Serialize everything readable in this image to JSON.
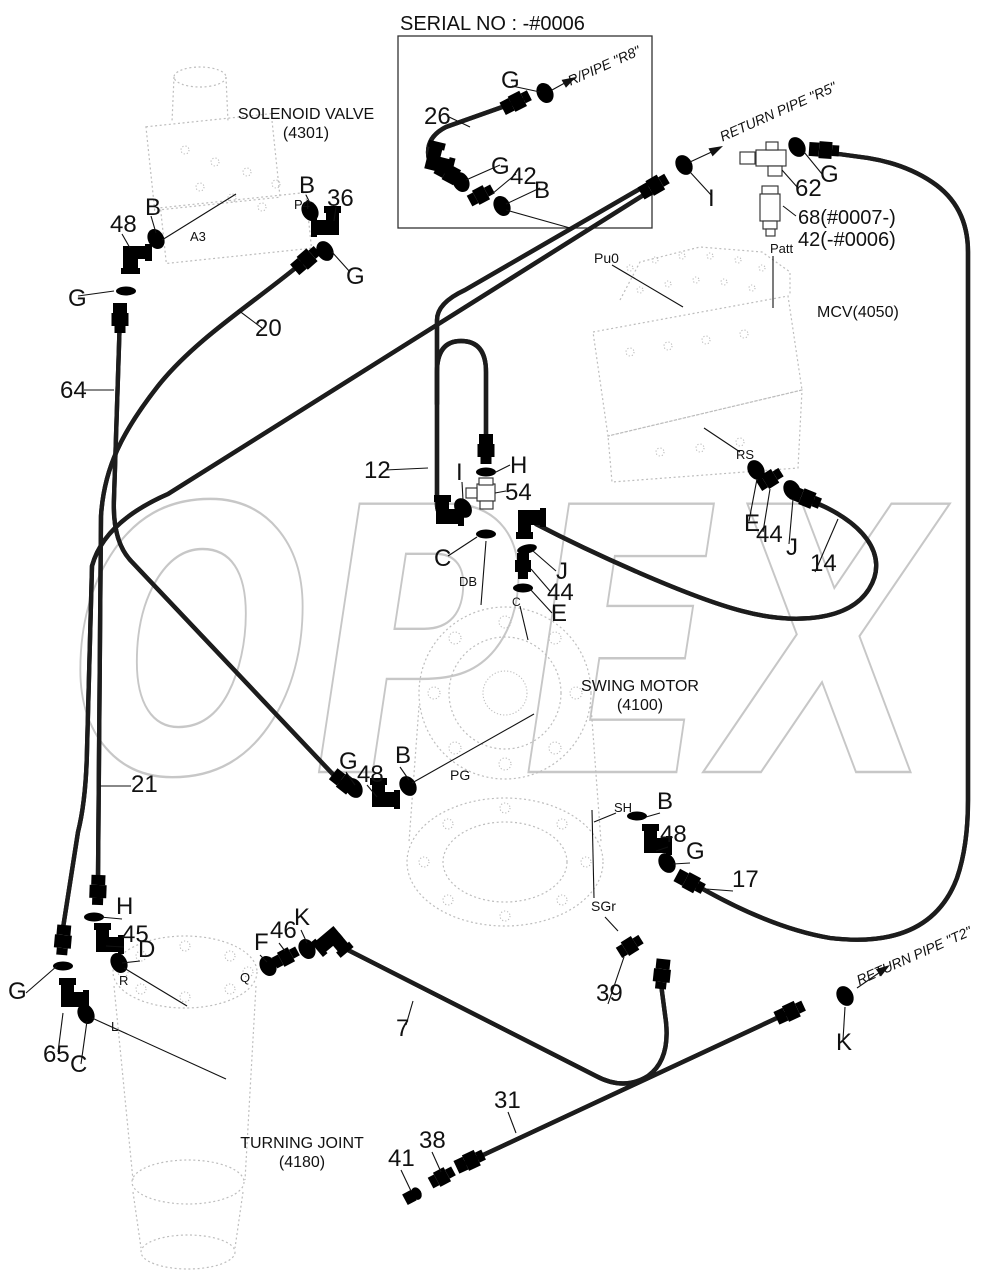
{
  "watermark": "OPEX",
  "serial_box": {
    "title": "SERIAL NO : -#0006"
  },
  "components": [
    {
      "name": "SOLENOID VALVE",
      "code": "(4301)"
    },
    {
      "name": "MCV",
      "code": "(4050)"
    },
    {
      "name": "SWING MOTOR",
      "code": "(4100)"
    },
    {
      "name": "TURNING JOINT",
      "code": "(4180)"
    }
  ],
  "pipe_refs": [
    "R/PIPE \"R8\"",
    "RETURN PIPE \"R5\"",
    "RETURN PIPE \"T2\""
  ],
  "part_numbers": [
    "7",
    "12",
    "14",
    "17",
    "20",
    "21",
    "26",
    "31",
    "36",
    "38",
    "39",
    "41",
    "42",
    "44",
    "45",
    "46",
    "48",
    "54",
    "62",
    "64",
    "65",
    "68(#0007-)",
    "42(-#0006)"
  ],
  "seal_callouts": [
    "B",
    "C",
    "D",
    "E",
    "F",
    "G",
    "H",
    "I",
    "J",
    "K"
  ],
  "port_labels": [
    "A3",
    "P4",
    "Pu0",
    "Patt",
    "RS",
    "DB",
    "C",
    "PG",
    "SH",
    "SGr",
    "R",
    "L",
    "Q"
  ],
  "labels": [
    {
      "t": "SERIAL NO : -#0006",
      "x": 400,
      "y": 30,
      "fs": 20
    },
    {
      "t": "G",
      "x": 501,
      "y": 88,
      "fs": 24
    },
    {
      "t": "26",
      "x": 424,
      "y": 124,
      "fs": 24
    },
    {
      "t": "G",
      "x": 491,
      "y": 174,
      "fs": 24
    },
    {
      "t": "42",
      "x": 510,
      "y": 184,
      "fs": 24
    },
    {
      "t": "B",
      "x": 534,
      "y": 198,
      "fs": 24
    },
    {
      "t": "R/PIPE \"R8\"",
      "x": 606,
      "y": 70,
      "fs": 14,
      "i": 1,
      "r": -24,
      "a": "middle"
    },
    {
      "t": "SOLENOID VALVE",
      "x": 306,
      "y": 119,
      "fs": 16,
      "a": "middle"
    },
    {
      "t": "(4301)",
      "x": 306,
      "y": 138,
      "fs": 16,
      "a": "middle"
    },
    {
      "t": "48",
      "x": 110,
      "y": 232,
      "fs": 24
    },
    {
      "t": "B",
      "x": 145,
      "y": 215,
      "fs": 24
    },
    {
      "t": "B",
      "x": 299,
      "y": 193,
      "fs": 24
    },
    {
      "t": "P4",
      "x": 294,
      "y": 209,
      "fs": 13
    },
    {
      "t": "36",
      "x": 327,
      "y": 206,
      "fs": 24
    },
    {
      "t": "G",
      "x": 346,
      "y": 284,
      "fs": 24
    },
    {
      "t": "A3",
      "x": 190,
      "y": 241,
      "fs": 13
    },
    {
      "t": "20",
      "x": 255,
      "y": 336,
      "fs": 24
    },
    {
      "t": "G",
      "x": 68,
      "y": 306,
      "fs": 24
    },
    {
      "t": "64",
      "x": 60,
      "y": 398,
      "fs": 24
    },
    {
      "t": "RETURN PIPE \"R5\"",
      "x": 780,
      "y": 116,
      "fs": 14,
      "i": 1,
      "r": -24,
      "a": "middle"
    },
    {
      "t": "I",
      "x": 708,
      "y": 206,
      "fs": 24
    },
    {
      "t": "62",
      "x": 795,
      "y": 196,
      "fs": 24
    },
    {
      "t": "G",
      "x": 820,
      "y": 182,
      "fs": 24
    },
    {
      "t": "68(#0007-)",
      "x": 798,
      "y": 224,
      "fs": 20
    },
    {
      "t": "42(-#0006)",
      "x": 798,
      "y": 246,
      "fs": 20
    },
    {
      "t": "Patt",
      "x": 770,
      "y": 253,
      "fs": 13
    },
    {
      "t": "Pu0",
      "x": 594,
      "y": 263,
      "fs": 14
    },
    {
      "t": "MCV(4050)",
      "x": 817,
      "y": 317,
      "fs": 16
    },
    {
      "t": "12",
      "x": 364,
      "y": 478,
      "fs": 24
    },
    {
      "t": "I",
      "x": 456,
      "y": 480,
      "fs": 24
    },
    {
      "t": "H",
      "x": 510,
      "y": 473,
      "fs": 24
    },
    {
      "t": "54",
      "x": 505,
      "y": 500,
      "fs": 24
    },
    {
      "t": "C",
      "x": 434,
      "y": 566,
      "fs": 24
    },
    {
      "t": "DB",
      "x": 459,
      "y": 586,
      "fs": 13
    },
    {
      "t": "J",
      "x": 556,
      "y": 579,
      "fs": 24
    },
    {
      "t": "44",
      "x": 547,
      "y": 600,
      "fs": 24
    },
    {
      "t": "E",
      "x": 551,
      "y": 621,
      "fs": 24
    },
    {
      "t": "C",
      "x": 512,
      "y": 606,
      "fs": 12
    },
    {
      "t": "RS",
      "x": 736,
      "y": 459,
      "fs": 13
    },
    {
      "t": "E",
      "x": 744,
      "y": 531,
      "fs": 24
    },
    {
      "t": "44",
      "x": 756,
      "y": 542,
      "fs": 24
    },
    {
      "t": "J",
      "x": 786,
      "y": 555,
      "fs": 24
    },
    {
      "t": "14",
      "x": 810,
      "y": 571,
      "fs": 24
    },
    {
      "t": "SWING MOTOR",
      "x": 640,
      "y": 691,
      "fs": 16,
      "a": "middle"
    },
    {
      "t": "(4100)",
      "x": 640,
      "y": 710,
      "fs": 16,
      "a": "middle"
    },
    {
      "t": "PG",
      "x": 450,
      "y": 780,
      "fs": 14
    },
    {
      "t": "21",
      "x": 131,
      "y": 792,
      "fs": 24
    },
    {
      "t": "G",
      "x": 339,
      "y": 769,
      "fs": 24
    },
    {
      "t": "48",
      "x": 357,
      "y": 782,
      "fs": 24
    },
    {
      "t": "B",
      "x": 395,
      "y": 763,
      "fs": 24
    },
    {
      "t": "B",
      "x": 657,
      "y": 809,
      "fs": 24
    },
    {
      "t": "SH",
      "x": 614,
      "y": 812,
      "fs": 13
    },
    {
      "t": "48",
      "x": 660,
      "y": 842,
      "fs": 24
    },
    {
      "t": "G",
      "x": 686,
      "y": 859,
      "fs": 24
    },
    {
      "t": "17",
      "x": 732,
      "y": 887,
      "fs": 24
    },
    {
      "t": "SGr",
      "x": 591,
      "y": 911,
      "fs": 14
    },
    {
      "t": "39",
      "x": 596,
      "y": 1001,
      "fs": 24
    },
    {
      "t": "H",
      "x": 116,
      "y": 914,
      "fs": 24
    },
    {
      "t": "45",
      "x": 122,
      "y": 942,
      "fs": 24
    },
    {
      "t": "D",
      "x": 138,
      "y": 957,
      "fs": 24
    },
    {
      "t": "G",
      "x": 8,
      "y": 999,
      "fs": 24
    },
    {
      "t": "R",
      "x": 119,
      "y": 985,
      "fs": 13
    },
    {
      "t": "65",
      "x": 43,
      "y": 1062,
      "fs": 24
    },
    {
      "t": "C",
      "x": 70,
      "y": 1072,
      "fs": 24
    },
    {
      "t": "L",
      "x": 111,
      "y": 1031,
      "fs": 13
    },
    {
      "t": "F",
      "x": 254,
      "y": 950,
      "fs": 24
    },
    {
      "t": "46",
      "x": 270,
      "y": 938,
      "fs": 24
    },
    {
      "t": "K",
      "x": 294,
      "y": 925,
      "fs": 24
    },
    {
      "t": "Q",
      "x": 240,
      "y": 982,
      "fs": 13
    },
    {
      "t": "7",
      "x": 396,
      "y": 1036,
      "fs": 24
    },
    {
      "t": "TURNING JOINT",
      "x": 302,
      "y": 1148,
      "fs": 16,
      "a": "middle"
    },
    {
      "t": "(4180)",
      "x": 302,
      "y": 1167,
      "fs": 16,
      "a": "middle"
    },
    {
      "t": "31",
      "x": 494,
      "y": 1108,
      "fs": 24
    },
    {
      "t": "38",
      "x": 419,
      "y": 1148,
      "fs": 24
    },
    {
      "t": "41",
      "x": 388,
      "y": 1166,
      "fs": 24
    },
    {
      "t": "RETURN PIPE \"T2\"",
      "x": 916,
      "y": 960,
      "fs": 14,
      "i": 1,
      "r": -24,
      "a": "middle"
    },
    {
      "t": "K",
      "x": 836,
      "y": 1050,
      "fs": 24
    }
  ]
}
